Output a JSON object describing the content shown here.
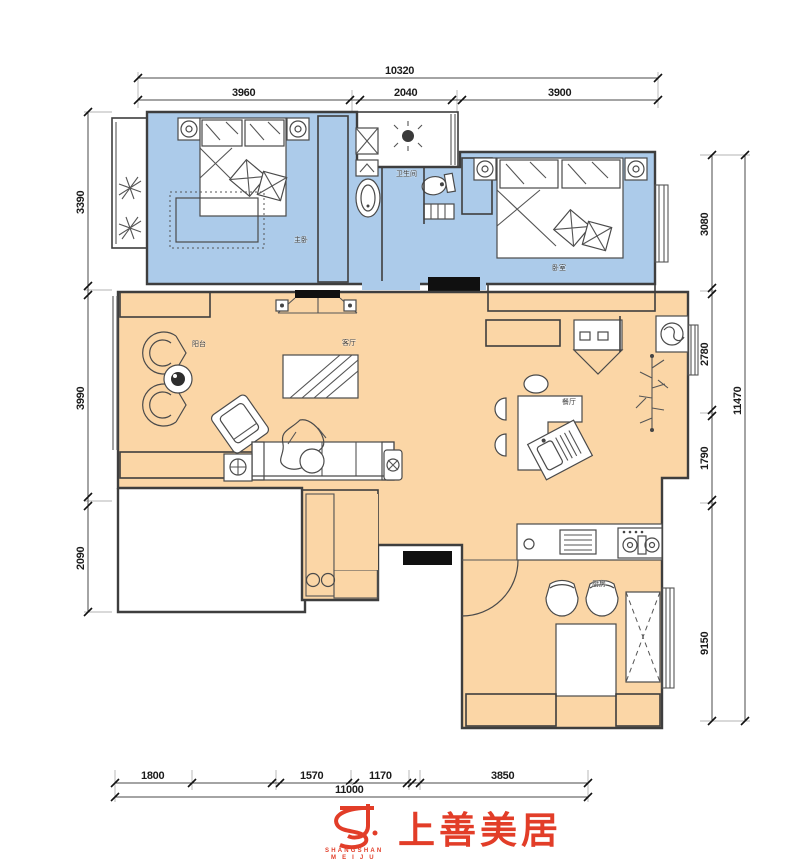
{
  "dimensions": {
    "top": {
      "overall": "10320",
      "seg1": "3960",
      "seg2": "2040",
      "seg3": "3900"
    },
    "left": {
      "seg1": "3390",
      "seg2": "3990",
      "seg3": "2090"
    },
    "right": {
      "overall": "11470",
      "seg1": "3080",
      "seg2": "2780",
      "seg3": "1790",
      "seg4": "9150"
    },
    "bottom": {
      "overall": "11000",
      "seg1": "1800",
      "seg2": "1570",
      "seg3": "1170",
      "seg4": "3850"
    }
  },
  "room_labels": {
    "master_bedroom": "主卧",
    "bathroom": "卫生间",
    "bedroom": "卧室",
    "living_room": "客厅",
    "dining_room": "餐厅",
    "kitchen": "厨房",
    "balcony": "阳台"
  },
  "logo": {
    "brand_cn": "上善美居",
    "brand_en_line1": "SHANGSHAN",
    "brand_en_line2": "M E I J U"
  },
  "colors": {
    "bedroom_zone_fill": "#accbea",
    "living_zone_fill": "#fbd6a6",
    "logo_red": "#e23d28",
    "wall_line": "#3e3e3e"
  }
}
